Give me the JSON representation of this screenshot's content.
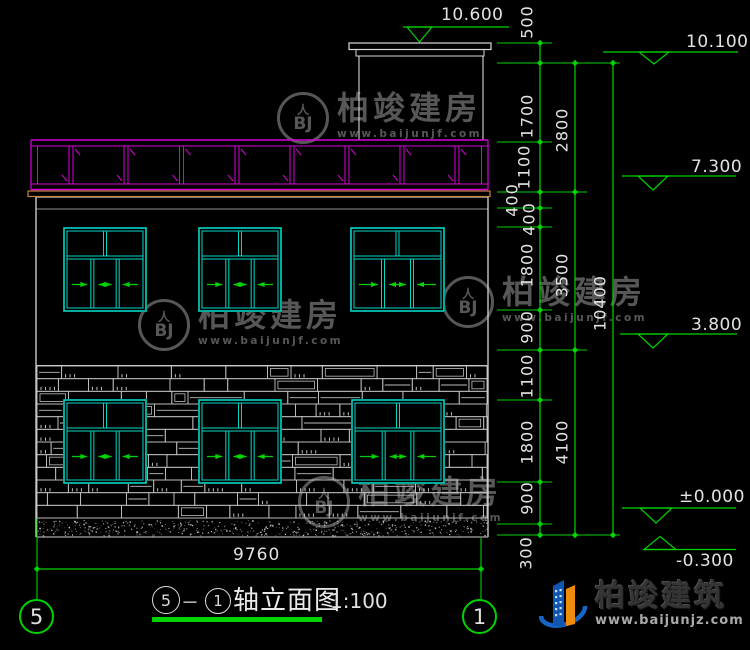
{
  "drawing": {
    "type": "building front elevation, CAD style",
    "scale_note": "1:100"
  },
  "colors": {
    "background": "#000000",
    "dimension_green": "#00d400",
    "window_cyan": "#00d8c6",
    "railing_magenta": "#d800d8",
    "roof_band_orange": "#c8833c",
    "line_white": "#d8d8d8",
    "line_gray": "#909090",
    "stone_gray": "#bdbdbd",
    "watermark_gray": "#575757"
  },
  "elevations": {
    "tower_roof": "10.600",
    "roof": "10.100",
    "upper_floor": "7.300",
    "second_floor": "3.800",
    "ground": "±0.000",
    "below_ground": "-0.300"
  },
  "dimensions": {
    "overall_width": "9760",
    "overall_height": "10400",
    "floor_heights": [
      "2800",
      "3500",
      "4100"
    ],
    "detail_chain": [
      "500",
      "1700",
      "1100",
      "400",
      "400",
      "1800",
      "900",
      "1100",
      "1800",
      "900",
      "300"
    ]
  },
  "axes": {
    "left": "5",
    "right": "1"
  },
  "title": {
    "axis_from": "5",
    "separator": "－",
    "axis_to": "1",
    "name": "轴立面图",
    "scale": "1:100"
  },
  "watermark": {
    "logo_roof": "人",
    "logo_initials": "BJ",
    "brand": "柏竣建房",
    "url": "www.baijunjf.com"
  },
  "footer_logo": {
    "brand": "柏竣建筑",
    "url": "www.baijunjz.com"
  }
}
